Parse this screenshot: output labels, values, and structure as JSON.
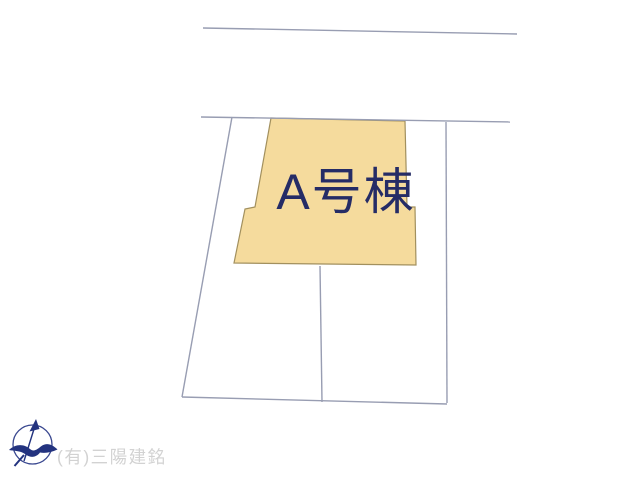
{
  "canvas": {
    "width": 640,
    "height": 480,
    "background": "#ffffff"
  },
  "site_plan": {
    "line_color": "#989db2",
    "line_width": 1.4,
    "boundary_segments": [
      {
        "name": "road-edge-top",
        "x1": 203,
        "y1": 28,
        "x2": 517,
        "y2": 34
      },
      {
        "name": "boundary-upper",
        "x1": 201,
        "y1": 117,
        "x2": 510,
        "y2": 122
      },
      {
        "name": "boundary-left",
        "x1": 232,
        "y1": 117,
        "x2": 182,
        "y2": 397
      },
      {
        "name": "boundary-bottom",
        "x1": 182,
        "y1": 397,
        "x2": 447,
        "y2": 404
      },
      {
        "name": "boundary-right",
        "x1": 446,
        "y1": 122,
        "x2": 447,
        "y2": 403
      },
      {
        "name": "lot-divider",
        "x1": 320,
        "y1": 266,
        "x2": 322,
        "y2": 402
      }
    ],
    "building": {
      "label": "A号棟",
      "fill": "#f5db9d",
      "stroke": "#a2905e",
      "label_color": "#252c66",
      "points": [
        [
          271,
          118
        ],
        [
          405,
          121
        ],
        [
          407,
          207
        ],
        [
          415,
          207
        ],
        [
          416,
          265
        ],
        [
          234,
          263
        ],
        [
          245,
          209
        ],
        [
          255,
          207
        ]
      ]
    }
  },
  "footer": {
    "company": "(有)三陽建銘",
    "company_color": "#d2d2d2",
    "compass_color": "#23337f",
    "compass_ring_color": "#3a4890"
  }
}
